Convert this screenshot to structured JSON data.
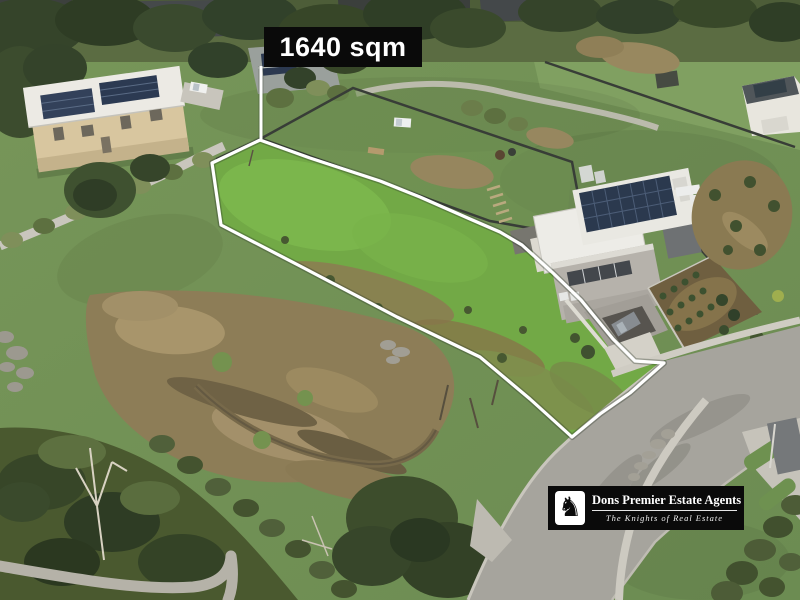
{
  "photo": {
    "type": "aerial-drone-photo",
    "area_label": "1640 sqm",
    "label_background": "#0a0a0a",
    "label_text_color": "#ffffff",
    "boundary_color": "#ffffff"
  },
  "agency": {
    "name": "Dons Premier Estate Agents",
    "tagline": "The Knights of Real Estate",
    "logo_icon": "chess-knight",
    "logo_glyph": "♞",
    "logo_background": "#0a0a0a",
    "logo_text_color": "#ffffff"
  }
}
